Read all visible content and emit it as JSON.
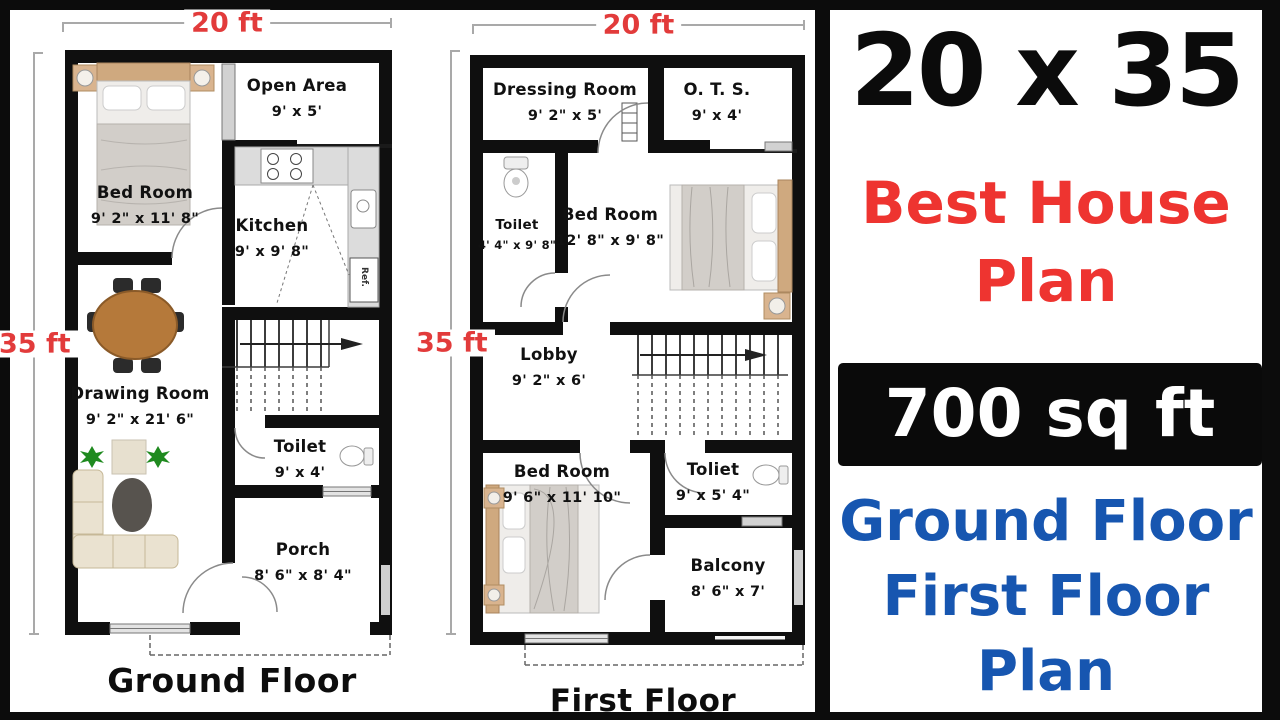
{
  "dimension_labels": {
    "ground_floor_width": "20 ft",
    "ground_floor_depth": "35 ft",
    "first_floor_width": "20 ft",
    "first_floor_depth": "35 ft"
  },
  "ground_floor": {
    "title": "Ground Floor",
    "fridge_label": "Ref.",
    "rooms": [
      {
        "name": "Bed Room",
        "dims": "9' 2\" x 11' 8\""
      },
      {
        "name": "Open Area",
        "dims": "9' x 5'"
      },
      {
        "name": "Kitchen",
        "dims": "9' x 9' 8\""
      },
      {
        "name": "Drawing Room",
        "dims": "9' 2\" x 21' 6\""
      },
      {
        "name": "Toilet",
        "dims": "9' x 4'"
      },
      {
        "name": "Porch",
        "dims": "8' 6\" x 8' 4\""
      }
    ]
  },
  "first_floor": {
    "title": "First Floor",
    "rooms": [
      {
        "name": "Dressing Room",
        "dims": "9' 2\" x 5'"
      },
      {
        "name": "O. T. S.",
        "dims": "9' x 4'"
      },
      {
        "name": "Toilet",
        "dims": "4' 4\" x 9' 8\""
      },
      {
        "name": "Bed Room",
        "dims": "12' 8\" x 9' 8\""
      },
      {
        "name": "Lobby",
        "dims": "9' 2\" x 6'"
      },
      {
        "name": "Bed Room",
        "dims": "9' 6\" x 11' 10\""
      },
      {
        "name": "Toliet",
        "dims": "9' x 5' 4\""
      },
      {
        "name": "Balcony",
        "dims": "8' 6\" x 7'"
      }
    ]
  },
  "right_panel": {
    "plot_size": "20 x 35",
    "headline_line1": "Best House",
    "headline_line2": "Plan",
    "area_badge": "700 sq ft",
    "caption_line1": "Ground Floor",
    "caption_line2": "First Floor",
    "caption_line3": "Plan"
  },
  "colors": {
    "dimension_red": "#e23b3b",
    "headline_red": "#ee3430",
    "caption_blue": "#1756b0",
    "badge_bg": "#0a0a0a",
    "badge_text": "#ffffff",
    "wall_black": "#0f0f0f"
  }
}
